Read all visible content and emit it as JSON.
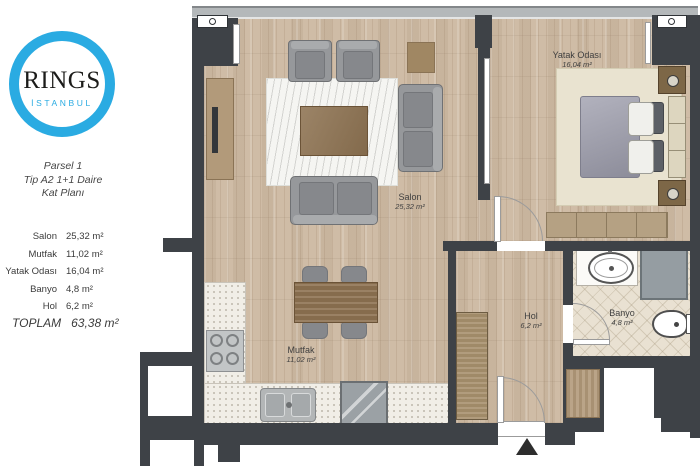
{
  "brand": {
    "name": "RINGS",
    "subtitle": "İSTANBUL",
    "ring_color": "#2aabe2"
  },
  "info": {
    "line1": "Parsel 1",
    "line2": "Tip A2  1+1 Daire",
    "line3": "Kat Planı"
  },
  "area_table": {
    "rows": [
      {
        "room": "Salon",
        "area": "25,32 m²"
      },
      {
        "room": "Mutfak",
        "area": "11,02 m²"
      },
      {
        "room": "Yatak Odası",
        "area": "16,04 m²"
      },
      {
        "room": "Banyo",
        "area": "4,8 m²"
      },
      {
        "room": "Hol",
        "area": "6,2 m²"
      }
    ],
    "total_label": "TOPLAM",
    "total_value": "63,38 m²"
  },
  "plan": {
    "rooms": [
      {
        "name": "Salon",
        "area": "25,32 m²"
      },
      {
        "name": "Yatak Odası",
        "area": "16,04 m²"
      },
      {
        "name": "Mutfak",
        "area": "11,02 m²"
      },
      {
        "name": "Hol",
        "area": "6,2 m²"
      },
      {
        "name": "Banyo",
        "area": "4,8 m²"
      }
    ]
  },
  "colors": {
    "wall": "#3e4247",
    "wood_floor": "#cfbca6",
    "tile_floor": "#e9e1d2",
    "brand_blue": "#2aabe2"
  }
}
